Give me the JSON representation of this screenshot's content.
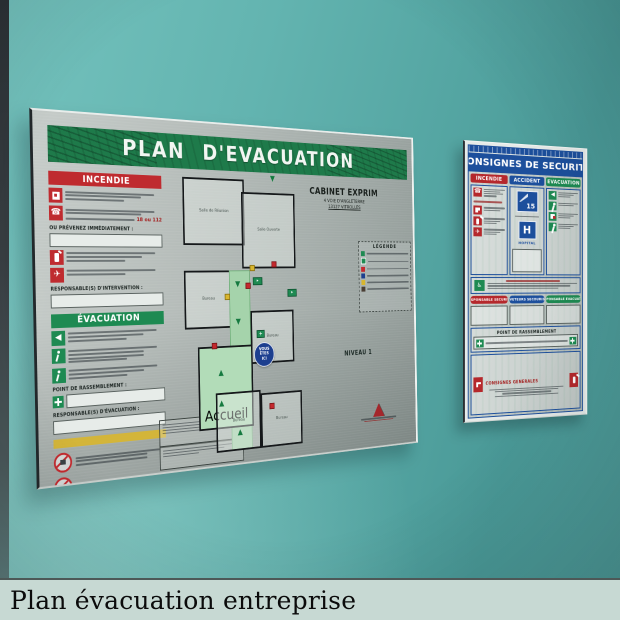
{
  "caption": {
    "text": "Plan évacuation entreprise"
  },
  "plan_board": {
    "title": "PLAN D'EVACUATION",
    "incendie": {
      "header": "INCENDIE",
      "alert_numbers": "18 ou 112",
      "prevenez_label": "OU PRÉVENEZ IMMÉDIATEMENT :",
      "responsable_label": "RESPONSABLE(S) D'INTERVENTION :"
    },
    "evacuation": {
      "header": "ÉVACUATION",
      "rassemblement_label": "POINT DE RASSEMBLEMENT :",
      "responsable_label": "RESPONSABLE(S) D'ÉVACUATION :"
    },
    "site": {
      "name": "CABINET EXPRIM",
      "address_line1": "4 VOIE D'ANGLETERRE",
      "address_line2": "13127 VITROLLES"
    },
    "legend_title": "LÉGENDE",
    "level_label": "NIVEAU 1",
    "you_are_here": {
      "line1": "VOUS",
      "line2": "ÊTES",
      "line3": "ICI"
    },
    "rooms": {
      "meeting": "Salle de Réunion",
      "open_room": "Salle Ouverte",
      "office1": "Bureau",
      "office2": "Bureau",
      "office3": "Bureau",
      "office4": "Bureau",
      "reception": "Accueil"
    }
  },
  "consignes_board": {
    "title": "CONSIGNES DE SECURITE",
    "col_incendie": "INCENDIE",
    "col_accident": "ACCIDENT",
    "col_evacuation": "EVACUATION",
    "samu_number": "15",
    "hospital_letter": "H",
    "hospital_label": "HOPITAL",
    "pill_red": "RESPONSABLE SECURITE",
    "pill_blue": "SAUVETEURS SECOURISTES",
    "pill_green": "RESPONSABLE EVACUATION",
    "rassemblement_label": "POINT DE RASSEMBLEMENT",
    "generales_label": "CONSIGNES GENERALES"
  },
  "colors": {
    "wall_teal": "#58aaa7",
    "sign_red": "#bf2b2f",
    "sign_green": "#1e8a52",
    "sign_blue": "#1d4f9c",
    "accent_yellow": "#d8b62e"
  }
}
